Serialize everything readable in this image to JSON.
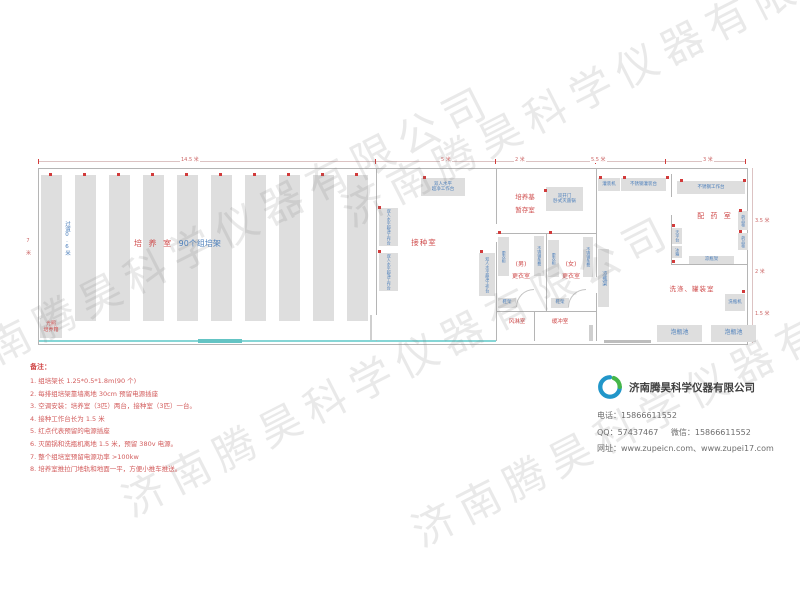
{
  "watermark": "济南腾昊科学仪器有限公司",
  "dimensions": {
    "top": [
      "14.5 米",
      "5 米",
      "2 米",
      "5.5 米",
      "3 米"
    ],
    "right": [
      "3.5 米",
      "2 米",
      "1.5 米"
    ],
    "left": "7 米"
  },
  "rooms": {
    "culture": {
      "name": "培 养 室",
      "racks_label": "90个组培架",
      "aisle": "过道0.6米",
      "incubator": "光照\n培养箱"
    },
    "inoculation": {
      "name": "接种室",
      "bench": "双人水平\n超净工作台",
      "bench_vertical": "双人水平超净工作台"
    },
    "medium_storage": {
      "name": "培养基\n暂存室",
      "sterilizer": "双开门\n卧式灭菌锅"
    },
    "changing": {
      "male": "(男)\n更衣室",
      "female": "(女)\n更衣室",
      "locker": "更衣柜",
      "bench": "不锈钢条凳",
      "shoe_rack": "鞋架"
    },
    "air_shower": "风淋室",
    "buffer_room": "缓冲室",
    "washing": {
      "name": "洗涤、罐装室",
      "filling_machine": "灌装机",
      "filling_table": "不锈钢灌装台",
      "bottle_washer": "洗瓶机",
      "soaking_pool": "泡瓶池",
      "cooling_rack": "凉瓶架"
    },
    "dispensing": {
      "name": "配 药 室",
      "worktable": "不锈钢工作台",
      "medicine_cabinet": "药品柜",
      "balance_table": "天平台",
      "fridge": "冰箱",
      "cooling_rack": "凉瓶架"
    }
  },
  "notes": {
    "title": "备注：",
    "items": [
      "1. 组培架长 1.25*0.5*1.8m(90 个)",
      "2. 每排组培架靠墙离地 30cm 预留电源插座",
      "3. 空调安装：培养室（3匹）两台，接种室（3匹）一台。",
      "4. 接种工作台长为 1.5 米",
      "5. 红点代表预留的电源插座",
      "6. 灭菌锅和洗瓶机离地 1.5 米，预留 380v 电源。",
      "7. 整个组培室预留电源功率 >100kw",
      "8. 培养室推拉门地轨和地面一平，方便小推车推送。"
    ]
  },
  "company": {
    "name": "济南腾昊科学仪器有限公司",
    "phone": "电话：15866611552",
    "qq": "QQ：57437467",
    "wechat": "微信：15866611552",
    "website": "网址：www.zupeicn.com、www.zupei17.com"
  }
}
